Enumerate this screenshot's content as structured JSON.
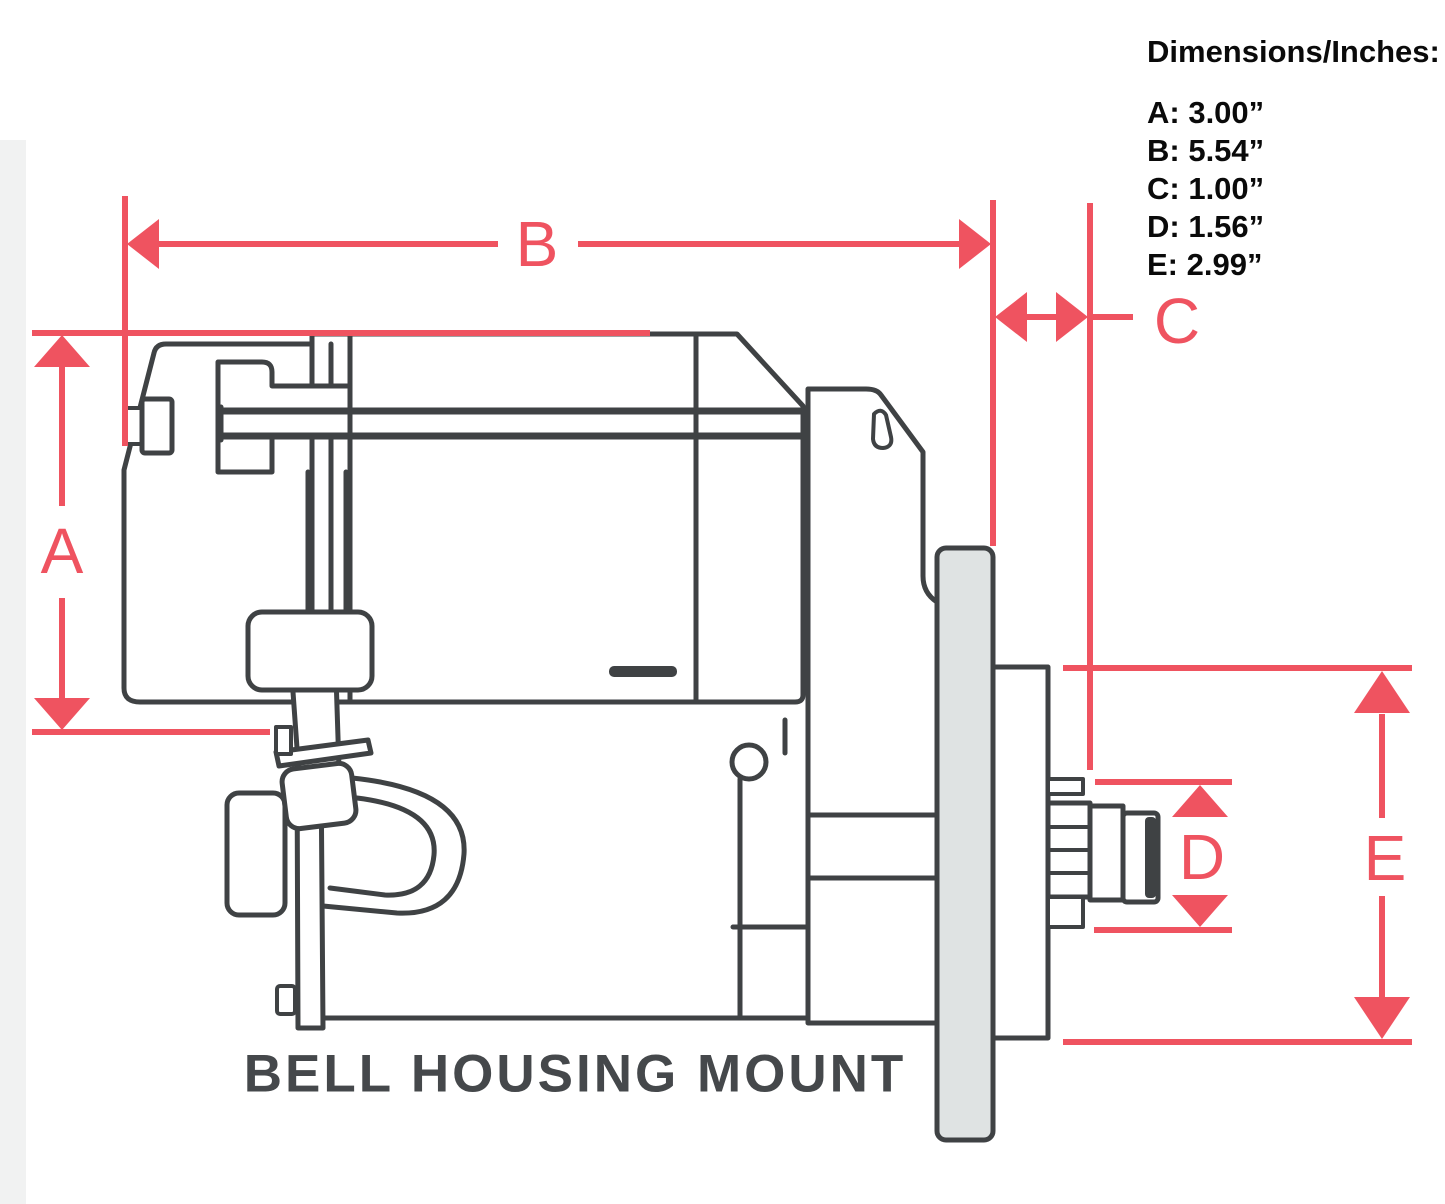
{
  "figure": {
    "type": "starter-motor-dimension-diagram",
    "caption": "BELL HOUSING MOUNT"
  },
  "panel": {
    "heading": "Dimensions/Inches:",
    "entries": [
      {
        "label": "A",
        "value": "3.00”",
        "text": "A: 3.00”"
      },
      {
        "label": "B",
        "value": "5.54”",
        "text": "B: 5.54”"
      },
      {
        "label": "C",
        "value": "1.00”",
        "text": "C: 1.00”"
      },
      {
        "label": "D",
        "value": "1.56”",
        "text": "D: 1.56”"
      },
      {
        "label": "E",
        "value": "2.99”",
        "text": "E: 2.99”"
      }
    ]
  },
  "dimension_labels": {
    "a": "A",
    "b": "B",
    "c": "C",
    "d": "D",
    "e": "E"
  },
  "colors": {
    "red": "#ef5360",
    "ink": "#3f4244",
    "flange": "#dfe3e3",
    "paper": "#ffffff",
    "caption": "#45484b"
  }
}
